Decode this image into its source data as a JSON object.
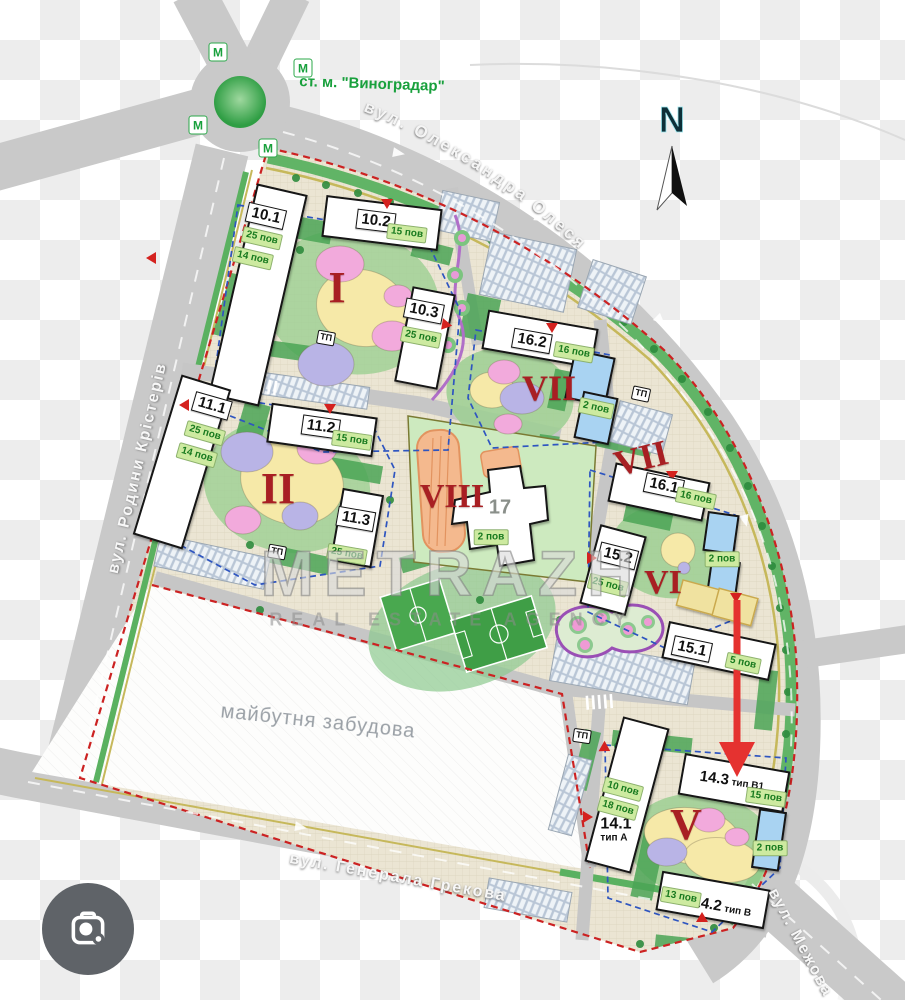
{
  "map": {
    "metro_station": "ст. м. \"Виноградар\"",
    "metro_marker": "М",
    "north_label": "N",
    "future_area": "майбутня забудова",
    "tp_label": "ТП",
    "kindergarten_floors": "2 пов",
    "streets": {
      "left": "вул. Родини Крістерів",
      "right": "вул. Олександра Олеся",
      "bottom": "вул. Генерала Грекова",
      "corner": "вул. Межова"
    },
    "romans": [
      "I",
      "II",
      "VII",
      "VIII",
      "VII",
      "VI",
      "V"
    ],
    "buildings": [
      {
        "num": "10.1",
        "floors": [
          "25 пов",
          "14 пов"
        ]
      },
      {
        "num": "10.2",
        "floors": [
          "15 пов"
        ]
      },
      {
        "num": "10.3",
        "floors": [
          "25 пов"
        ]
      },
      {
        "num": "11.1",
        "floors": [
          "25 пов",
          "14 пов"
        ]
      },
      {
        "num": "11.2",
        "floors": [
          "15 пов"
        ]
      },
      {
        "num": "11.3",
        "floors": [
          "25 пов"
        ]
      },
      {
        "num": "16.2",
        "floors": [
          "16 пов"
        ]
      },
      {
        "num": "16.1",
        "floors": [
          "16 пов"
        ]
      },
      {
        "num": "15.2",
        "floors": [
          "25 пов"
        ]
      },
      {
        "num": "15.1",
        "floors": [
          "5 пов"
        ]
      },
      {
        "num": "17",
        "floors": [
          "2 пов"
        ]
      },
      {
        "num": "14.1",
        "type": "тип А",
        "floors": [
          "10 пов",
          "18 пов"
        ]
      },
      {
        "num": "14.3",
        "type": "тип В1",
        "floors": [
          "15 пов"
        ]
      },
      {
        "num": "14.2",
        "type": "тип В",
        "floors": [
          "13 пов"
        ]
      }
    ],
    "watermark": {
      "title": "METRAZH",
      "subtitle": "REAL ESTATE AGENCY"
    },
    "colors": {
      "roman_red": "#a81f23",
      "badge_bg": "#cdeaa0",
      "badge_text": "#187a1f",
      "metro_green": "#18a03c",
      "boundary_red": "#cc2222",
      "block_blue": "#2e55c0",
      "road_gray": "#c9c9c9",
      "ground": "#ebe5d3",
      "kindergarten_blue": "#a9d3f2",
      "lens_bg": "#5f6368"
    }
  },
  "icons": {
    "lens": "google-lens-camera",
    "north_arrow": "north-arrow"
  }
}
